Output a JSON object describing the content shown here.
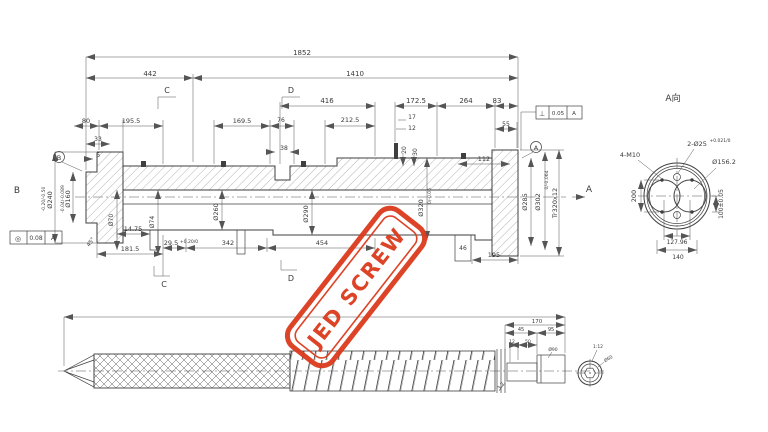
{
  "colors": {
    "line": "#3f3f3f",
    "dim": "#555555",
    "stamp": "#dc3a1c",
    "background": "#ffffff"
  },
  "stamp": {
    "text": "JED SCREW"
  },
  "main_view": {
    "overall": "1852",
    "seg_left": "442",
    "seg_right": "1410",
    "sec_c": "C",
    "sec_d": "D",
    "top": {
      "d416": "416",
      "d172_5": "172.5",
      "d264": "264",
      "d83": "83",
      "d80": "80",
      "d195_5": "195.5",
      "d169_5": "169.5",
      "d76": "76",
      "d212_5": "212.5",
      "d17": "17",
      "d12": "12",
      "d55": "55",
      "d33": "33",
      "d6": "6",
      "d38": "38",
      "d20": "20",
      "d30": "30",
      "d112": "112"
    },
    "dia": {
      "d240": "Ø240",
      "d240_tol": "-0.20/-0.50",
      "d160": "Ø160",
      "d160_tol": "-0.04/-0.089",
      "d70": "Ø70",
      "d74": "Ø74",
      "d260": "Ø260",
      "d290": "Ø290",
      "d320": "Ø320",
      "d320_tol": "0/-0.06",
      "d285": "Ø285",
      "d302": "Ø302",
      "d302_tol": "0/-0.064",
      "tr": "Tr320x12"
    },
    "bottom": {
      "d14_75": "14.75",
      "d181_5": "181.5",
      "d29_5": "29.5",
      "d29_5_tol": "+0.20/0",
      "d342": "342",
      "d454": "454",
      "d46": "46",
      "d195": "195",
      "chamfer": "45°",
      "sec_c": "C",
      "sec_d": "D"
    },
    "gdt_left": {
      "sym": "◎",
      "val": "0.08",
      "datum": "A"
    },
    "gdt_right": {
      "sym": "⊥",
      "val": "0.05",
      "datum": "A"
    },
    "datum_b": "B",
    "datum_a": "A",
    "view_b": "B",
    "view_a": "A"
  },
  "section_view": {
    "title": "A向",
    "bolt": "4-M10",
    "pin": "2-Ø25",
    "pin_tol": "+0.021/0",
    "bore": "Ø156.2",
    "h200": "200",
    "h100": "100±0.05",
    "w127": "127.96",
    "w140": "140"
  },
  "screw_view": {
    "d170": "170",
    "d45": "45",
    "d95": "95",
    "d12": "12",
    "d50": "50",
    "shank": "Ø90",
    "taper": "1:12",
    "end": "Ø60",
    "rough": "3.2"
  }
}
